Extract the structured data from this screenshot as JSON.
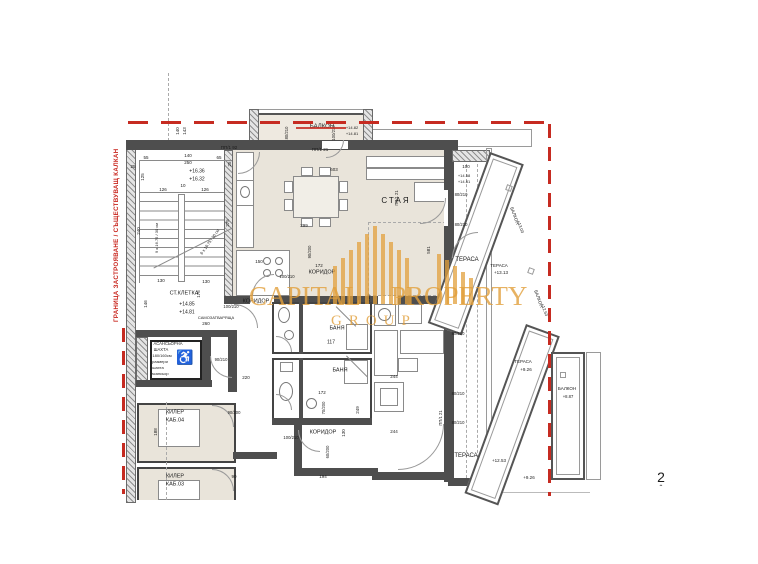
{
  "page": {
    "number": "2",
    "caret": "ˆ"
  },
  "boundary": {
    "label": "ГРАНИЦА ЗАСТРОЯВАНЕ / СЪЩЕСТВУВАЩ КАЛКАН",
    "color": "#c8251d"
  },
  "watermark": {
    "line1": "CAPITAL",
    "line2": "PROPERTY",
    "line3": "GROUP",
    "color": "#e2a03c",
    "bars": [
      [
        333,
        38
      ],
      [
        341,
        46
      ],
      [
        349,
        54
      ],
      [
        357,
        62
      ],
      [
        365,
        70
      ],
      [
        373,
        78
      ],
      [
        381,
        70
      ],
      [
        389,
        62
      ],
      [
        397,
        54
      ],
      [
        405,
        46
      ],
      [
        437,
        50
      ],
      [
        445,
        44
      ],
      [
        453,
        38
      ],
      [
        461,
        32
      ],
      [
        469,
        26
      ]
    ]
  },
  "elevator": {
    "icon": "♿"
  },
  "annotations": [
    {
      "t": "БАЛКОН",
      "x": 322,
      "y": 127,
      "s": 6
    },
    {
      "t": "80/210",
      "x": 287,
      "y": 133,
      "s": 4.2,
      "r": -90
    },
    {
      "t": "100/210",
      "x": 334,
      "y": 133,
      "s": 4.2,
      "r": -90
    },
    {
      "t": "+14.82",
      "x": 352,
      "y": 128,
      "s": 4
    },
    {
      "t": "+14.81",
      "x": 352,
      "y": 134,
      "s": 4
    },
    {
      "t": "ПП/1 21",
      "x": 320,
      "y": 150,
      "s": 4.5
    },
    {
      "t": "ПП/1 92",
      "x": 229,
      "y": 148,
      "s": 4.5
    },
    {
      "t": "140",
      "x": 178,
      "y": 131,
      "s": 4.5,
      "r": -90
    },
    {
      "t": "143",
      "x": 185,
      "y": 131,
      "s": 4.5,
      "r": -90
    },
    {
      "t": "55",
      "x": 146,
      "y": 158,
      "s": 4.5
    },
    {
      "t": "140",
      "x": 188,
      "y": 156,
      "s": 4.5
    },
    {
      "t": "250",
      "x": 188,
      "y": 163,
      "s": 4.5
    },
    {
      "t": "65",
      "x": 219,
      "y": 158,
      "s": 4.5
    },
    {
      "t": "25",
      "x": 133,
      "y": 167,
      "s": 4.5
    },
    {
      "t": "25",
      "x": 230,
      "y": 164,
      "s": 4.5,
      "r": -90
    },
    {
      "t": "125",
      "x": 143,
      "y": 177,
      "s": 4.5,
      "r": -90
    },
    {
      "t": "+16.36",
      "x": 197,
      "y": 172,
      "s": 5
    },
    {
      "t": "+16.32",
      "x": 197,
      "y": 180,
      "s": 5
    },
    {
      "t": "126",
      "x": 163,
      "y": 190,
      "s": 4.5
    },
    {
      "t": "10",
      "x": 183,
      "y": 186,
      "s": 4.5
    },
    {
      "t": "126",
      "x": 205,
      "y": 190,
      "s": 4.5
    },
    {
      "t": "240",
      "x": 139,
      "y": 231,
      "s": 4.5,
      "r": -90
    },
    {
      "t": "9 x 16.75 / 30 см",
      "x": 157,
      "y": 238,
      "s": 4,
      "r": -90
    },
    {
      "t": "275",
      "x": 228,
      "y": 223,
      "s": 4.5,
      "r": -90
    },
    {
      "t": "6 x 16.75 / 30 см",
      "x": 210,
      "y": 242,
      "s": 4,
      "r": -55
    },
    {
      "t": "130",
      "x": 161,
      "y": 281,
      "s": 4.5
    },
    {
      "t": "130",
      "x": 206,
      "y": 282,
      "s": 4.5
    },
    {
      "t": "146",
      "x": 146,
      "y": 304,
      "s": 4.5,
      "r": -90
    },
    {
      "t": "176",
      "x": 199,
      "y": 294,
      "s": 4.5,
      "r": -90
    },
    {
      "t": "СТ.КЛЕТКА",
      "x": 184,
      "y": 294,
      "s": 5.5
    },
    {
      "t": "+14.85",
      "x": 187,
      "y": 305,
      "s": 5
    },
    {
      "t": "+14.81",
      "x": 187,
      "y": 313,
      "s": 5
    },
    {
      "t": "260",
      "x": 206,
      "y": 324,
      "s": 4.5
    },
    {
      "t": "САМОЗАТВАРЯЩА",
      "x": 216,
      "y": 318,
      "s": 4
    },
    {
      "t": "100/210",
      "x": 231,
      "y": 307,
      "s": 4.2
    },
    {
      "t": "КОРИДОР",
      "x": 256,
      "y": 302,
      "s": 5.5
    },
    {
      "t": "АСАНСЬОРНА",
      "x": 168,
      "y": 344,
      "s": 4.2
    },
    {
      "t": "ШАХТА",
      "x": 161,
      "y": 350,
      "s": 4.2
    },
    {
      "t": "180/160см",
      "x": 162,
      "y": 356,
      "s": 4
    },
    {
      "t": "размери",
      "x": 160,
      "y": 362,
      "s": 4
    },
    {
      "t": "шахта",
      "x": 158,
      "y": 368,
      "s": 4
    },
    {
      "t": "асансьор",
      "x": 160,
      "y": 374,
      "s": 4
    },
    {
      "t": "90/210",
      "x": 221,
      "y": 360,
      "s": 4.2
    },
    {
      "t": "220",
      "x": 246,
      "y": 378,
      "s": 4.5
    },
    {
      "t": "КИЛЕР",
      "x": 175,
      "y": 413,
      "s": 5.5
    },
    {
      "t": "КАБ.04",
      "x": 175,
      "y": 421,
      "s": 5.5
    },
    {
      "t": "90/200",
      "x": 234,
      "y": 413,
      "s": 4.2
    },
    {
      "t": "188",
      "x": 156,
      "y": 432,
      "s": 4.5,
      "r": -90
    },
    {
      "t": "КИЛЕР",
      "x": 175,
      "y": 477,
      "s": 5.5
    },
    {
      "t": "КАБ.03",
      "x": 175,
      "y": 485,
      "s": 5.5
    },
    {
      "t": "90",
      "x": 234,
      "y": 477,
      "s": 4.5
    },
    {
      "t": "100/210",
      "x": 291,
      "y": 438,
      "s": 4.2
    },
    {
      "t": "603",
      "x": 334,
      "y": 170,
      "s": 4.5
    },
    {
      "t": "299",
      "x": 304,
      "y": 226,
      "s": 4.5
    },
    {
      "t": "150",
      "x": 259,
      "y": 262,
      "s": 4.5
    },
    {
      "t": "100/210",
      "x": 287,
      "y": 277,
      "s": 4.2
    },
    {
      "t": "90/200",
      "x": 310,
      "y": 252,
      "s": 4.2,
      "r": -90
    },
    {
      "t": "172",
      "x": 319,
      "y": 266,
      "s": 4.5
    },
    {
      "t": "КОРИДОР",
      "x": 322,
      "y": 273,
      "s": 5.5
    },
    {
      "t": "СТАЯ",
      "x": 396,
      "y": 201,
      "s": 8,
      "sp": 2
    },
    {
      "t": "286",
      "x": 369,
      "y": 298,
      "s": 4.5,
      "r": -90
    },
    {
      "t": "581",
      "x": 429,
      "y": 250,
      "s": 4.5,
      "r": -90
    },
    {
      "t": "ПП/1 21",
      "x": 397,
      "y": 198,
      "s": 4.2,
      "r": -90
    },
    {
      "t": "БАНЯ",
      "x": 337,
      "y": 329,
      "s": 5.5
    },
    {
      "t": "117",
      "x": 331,
      "y": 343,
      "s": 5
    },
    {
      "t": "БАНЯ",
      "x": 340,
      "y": 371,
      "s": 5.5
    },
    {
      "t": "172",
      "x": 322,
      "y": 393,
      "s": 4.5
    },
    {
      "t": "70/200",
      "x": 324,
      "y": 408,
      "s": 4.2,
      "r": -90
    },
    {
      "t": "249",
      "x": 358,
      "y": 410,
      "s": 4.5,
      "r": -90
    },
    {
      "t": "130",
      "x": 344,
      "y": 433,
      "s": 4.5,
      "r": -90
    },
    {
      "t": "60/200",
      "x": 328,
      "y": 452,
      "s": 4.2,
      "r": -90
    },
    {
      "t": "194",
      "x": 323,
      "y": 477,
      "s": 4.5
    },
    {
      "t": "КОРИДОР",
      "x": 323,
      "y": 433,
      "s": 5.5
    },
    {
      "t": "244",
      "x": 394,
      "y": 377,
      "s": 4.5
    },
    {
      "t": "244",
      "x": 394,
      "y": 432,
      "s": 4.5
    },
    {
      "t": "100",
      "x": 466,
      "y": 167,
      "s": 4.5
    },
    {
      "t": "+14.58",
      "x": 464,
      "y": 176,
      "s": 4
    },
    {
      "t": "+14.81",
      "x": 464,
      "y": 182,
      "s": 4
    },
    {
      "t": "80/210",
      "x": 461,
      "y": 195,
      "s": 4.2
    },
    {
      "t": "80/210",
      "x": 461,
      "y": 225,
      "s": 4.2
    },
    {
      "t": "ТЕРАСА",
      "x": 467,
      "y": 260,
      "s": 6
    },
    {
      "t": "80/210",
      "x": 458,
      "y": 334,
      "s": 4.2
    },
    {
      "t": "80/210",
      "x": 458,
      "y": 394,
      "s": 4.2
    },
    {
      "t": "80/210",
      "x": 458,
      "y": 423,
      "s": 4.2
    },
    {
      "t": "ПП/1 21",
      "x": 441,
      "y": 418,
      "s": 4.2,
      "r": -90
    },
    {
      "t": "ТЕРАСА",
      "x": 466,
      "y": 456,
      "s": 6
    },
    {
      "t": "+12.53",
      "x": 499,
      "y": 461,
      "s": 4.5
    },
    {
      "t": "ТЕРАСА",
      "x": 499,
      "y": 266,
      "s": 4.5
    },
    {
      "t": "+13.13",
      "x": 501,
      "y": 273,
      "s": 4.5
    },
    {
      "t": "БАЛКОН",
      "x": 514,
      "y": 216,
      "s": 4.5,
      "r": 70
    },
    {
      "t": "+13.03",
      "x": 520,
      "y": 227,
      "s": 4.2,
      "r": 70
    },
    {
      "t": "БАЛКОН",
      "x": 538,
      "y": 299,
      "s": 4.5,
      "r": 70
    },
    {
      "t": "+12.53",
      "x": 544,
      "y": 310,
      "s": 4.2,
      "r": 70
    },
    {
      "t": "ТЕРАСА",
      "x": 523,
      "y": 362,
      "s": 4.5
    },
    {
      "t": "+9.26",
      "x": 526,
      "y": 370,
      "s": 4.5
    },
    {
      "t": "БАЛКОН",
      "x": 567,
      "y": 389,
      "s": 4.5
    },
    {
      "t": "+8.87",
      "x": 568,
      "y": 397,
      "s": 4.2
    },
    {
      "t": "+9.26",
      "x": 529,
      "y": 478,
      "s": 4.5
    },
    {
      "t": "2",
      "x": 661,
      "y": 477,
      "s": 14
    },
    {
      "t": "ˆ",
      "x": 661,
      "y": 489,
      "s": 8
    }
  ]
}
